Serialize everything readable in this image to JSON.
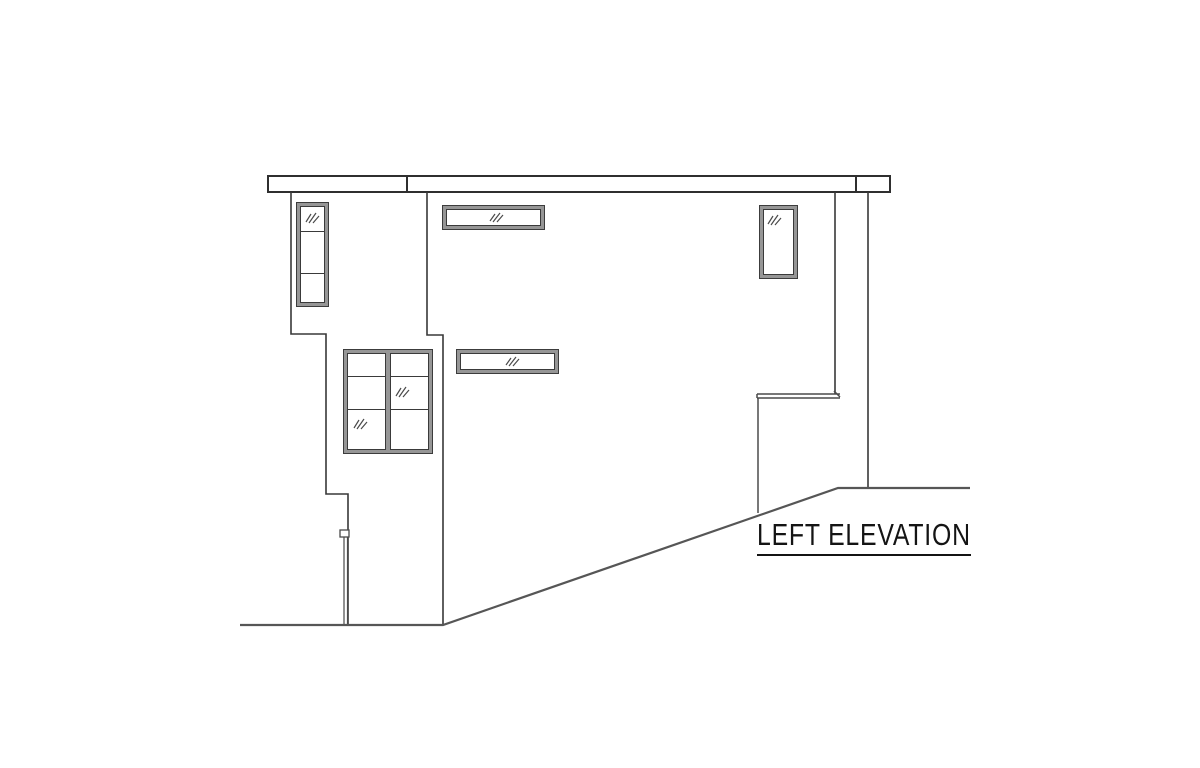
{
  "title": {
    "label": "LEFT ELEVATION"
  },
  "colors": {
    "background": "#ffffff",
    "wall_line": "#383838",
    "fascia_line": "#2f2f2f",
    "ground_line": "#565656",
    "window_frame_gray": "#969696",
    "window_edge_line": "#3c3c3c",
    "glazing_mark": "#4a4a4a",
    "text": "#141414"
  },
  "drawing": {
    "windows": [
      {
        "id": "tall-left-window",
        "panes": 3,
        "glazing_marks": 1
      },
      {
        "id": "upper-strip-window",
        "panes": 1,
        "glazing_marks": 1
      },
      {
        "id": "right-vertical-window",
        "panes": 1,
        "glazing_marks": 1
      },
      {
        "id": "mid-strip-window",
        "panes": 1,
        "glazing_marks": 1
      },
      {
        "id": "grid-window",
        "panes": 6,
        "glazing_marks": 2
      }
    ],
    "features": [
      "roof-fascia-band",
      "stepped-left-wall",
      "right-wall",
      "patio-wall-with-cap",
      "downspout",
      "flat-grade-left",
      "sloped-grade",
      "flat-grade-right"
    ]
  }
}
